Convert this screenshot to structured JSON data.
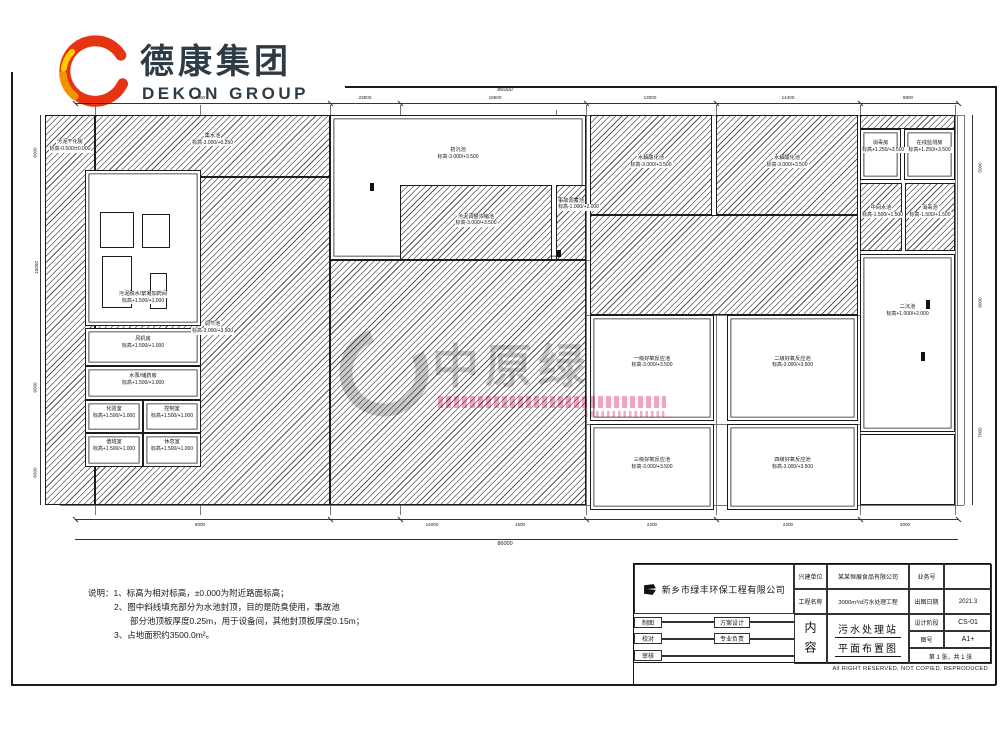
{
  "logo": {
    "title": "德康集团",
    "subtitle": "DEKON GROUP",
    "colors": {
      "red": "#e63312",
      "orange": "#f29400",
      "yellow": "#ffcf00",
      "text": "#2e3b45"
    }
  },
  "watermark": {
    "text": "中原绿",
    "accent_pink": "#ee86a6",
    "gray": "#c7c7c7"
  },
  "plan": {
    "tanks": [
      {
        "name": "污泥干化房",
        "elev": "标高-0.500/±0.000",
        "x": 45,
        "y": 115,
        "w": 50,
        "h": 390,
        "hatch": true,
        "lt": 6
      },
      {
        "name": "集水池",
        "elev": "标高-3.000/+0.250",
        "x": 95,
        "y": 115,
        "w": 235,
        "h": 62,
        "hatch": true,
        "lt": 28
      },
      {
        "name": "调节池",
        "elev": "标高-3.000/+3.500",
        "x": 95,
        "y": 177,
        "w": 235,
        "h": 328,
        "hatch": true,
        "lt": 44
      },
      {
        "name": "初沉池",
        "elev": "标高-3.000/+3.500",
        "x": 330,
        "y": 115,
        "w": 256,
        "h": 145,
        "hatch": false,
        "lt": 22
      },
      {
        "name": "",
        "elev": "",
        "x": 330,
        "y": 260,
        "w": 256,
        "h": 245,
        "hatch": true,
        "lt": 40
      },
      {
        "name": "污泥调整浓缩池",
        "elev": "标高-3.000/+3.500",
        "x": 400,
        "y": 185,
        "w": 152,
        "h": 75,
        "hatch": true,
        "lt": 38
      },
      {
        "name": "事故调蓄池",
        "elev": "标高-1.000/+2.000",
        "x": 556,
        "y": 185,
        "w": 30,
        "h": 75,
        "hatch": true,
        "lt": 16
      },
      {
        "name": "水解酸化池",
        "elev": "标高-3.000/+3.500",
        "x": 590,
        "y": 115,
        "w": 122,
        "h": 100,
        "hatch": true,
        "lt": 40
      },
      {
        "name": "水解酸化池",
        "elev": "标高-3.000/+3.500",
        "x": 716,
        "y": 115,
        "w": 142,
        "h": 100,
        "hatch": true,
        "lt": 40
      },
      {
        "name": "",
        "elev": "",
        "x": 590,
        "y": 215,
        "w": 268,
        "h": 100,
        "hatch": true,
        "lt": 40
      },
      {
        "name": "一级好氧反应池",
        "elev": "标高-3.000/+3.500",
        "x": 590,
        "y": 315,
        "w": 124,
        "h": 106,
        "hatch": false,
        "lt": 38
      },
      {
        "name": "二级好氧反应池",
        "elev": "标高-3.000/+3.500",
        "x": 727,
        "y": 315,
        "w": 131,
        "h": 106,
        "hatch": false,
        "lt": 38
      },
      {
        "name": "三级好氧反应池",
        "elev": "标高-3.000/+3.500",
        "x": 590,
        "y": 424,
        "w": 124,
        "h": 86,
        "hatch": false,
        "lt": 38
      },
      {
        "name": "四级好氧反应池",
        "elev": "标高-3.000/+3.500",
        "x": 727,
        "y": 424,
        "w": 131,
        "h": 86,
        "hatch": false,
        "lt": 38
      },
      {
        "name": "",
        "elev": "",
        "x": 860,
        "y": 115,
        "w": 95,
        "h": 14,
        "hatch": true,
        "lt": 10
      },
      {
        "name": "消毒房",
        "elev": "标高+1.250/+3.500",
        "x": 860,
        "y": 129,
        "w": 41,
        "h": 51,
        "hatch": false,
        "lt": 20
      },
      {
        "name": "在线监测房",
        "elev": "标高+1.250/+3.500",
        "x": 904,
        "y": 129,
        "w": 51,
        "h": 51,
        "hatch": false,
        "lt": 20
      },
      {
        "name": "中间水池",
        "elev": "标高-1.500/+1.500",
        "x": 860,
        "y": 183,
        "w": 42,
        "h": 68,
        "hatch": true,
        "lt": 32
      },
      {
        "name": "消毒池",
        "elev": "标高-1.500/+1.500",
        "x": 905,
        "y": 183,
        "w": 50,
        "h": 68,
        "hatch": true,
        "lt": 32
      },
      {
        "name": "二沉池",
        "elev": "标高+1.000/+2.000",
        "x": 860,
        "y": 254,
        "w": 95,
        "h": 178,
        "hatch": false,
        "lt": 28
      },
      {
        "name": "",
        "elev": "",
        "x": 860,
        "y": 434,
        "w": 95,
        "h": 71,
        "hatch": false,
        "lt": 40
      },
      {
        "name": "污泥脱水/絮凝加药间",
        "elev": "标高+1.500/+1.000",
        "x": 85,
        "y": 170,
        "w": 116,
        "h": 156,
        "hatch": false,
        "lt": 78
      },
      {
        "name": "风机房",
        "elev": "标高+1.500/+1.000",
        "x": 85,
        "y": 328,
        "w": 116,
        "h": 38,
        "hatch": false,
        "lt": 20
      },
      {
        "name": "水泵/储药房",
        "elev": "标高+1.500/+1.000",
        "x": 85,
        "y": 366,
        "w": 116,
        "h": 34,
        "hatch": false,
        "lt": 18
      },
      {
        "name": "化验室",
        "elev": "标高+1.500/+1.000",
        "x": 85,
        "y": 400,
        "w": 58,
        "h": 33,
        "hatch": false,
        "lt": 16
      },
      {
        "name": "控制室",
        "elev": "标高+1.500/+1.000",
        "x": 143,
        "y": 400,
        "w": 58,
        "h": 33,
        "hatch": false,
        "lt": 16
      },
      {
        "name": "值班室",
        "elev": "标高+1.500/+1.000",
        "x": 85,
        "y": 433,
        "w": 58,
        "h": 34,
        "hatch": false,
        "lt": 16
      },
      {
        "name": "休息室",
        "elev": "标高+1.500/+1.000",
        "x": 143,
        "y": 433,
        "w": 58,
        "h": 34,
        "hatch": false,
        "lt": 16
      }
    ],
    "equipment": [
      {
        "x": 100,
        "y": 212,
        "w": 34,
        "h": 36
      },
      {
        "x": 142,
        "y": 214,
        "w": 28,
        "h": 34
      },
      {
        "x": 102,
        "y": 256,
        "w": 30,
        "h": 52
      },
      {
        "x": 150,
        "y": 273,
        "w": 17,
        "h": 36
      }
    ],
    "marks": [
      {
        "x": 926,
        "y": 300,
        "w": 4,
        "h": 9
      },
      {
        "x": 921,
        "y": 352,
        "w": 4,
        "h": 9
      },
      {
        "x": 370,
        "y": 183,
        "w": 4,
        "h": 8
      },
      {
        "x": 556,
        "y": 250,
        "w": 5,
        "h": 7
      }
    ],
    "dims": {
      "top": [
        {
          "t": "8000",
          "x": 200
        },
        {
          "t": "23500",
          "x": 365
        },
        {
          "t": "18600",
          "x": 495
        },
        {
          "t": "13000",
          "x": 650
        },
        {
          "t": "14400",
          "x": 788
        },
        {
          "t": "9800",
          "x": 908
        }
      ],
      "top_total": "86000",
      "bottom": [
        {
          "t": "8000",
          "x": 200
        },
        {
          "t": "14000",
          "x": 432
        },
        {
          "t": "1500",
          "x": 520
        },
        {
          "t": "2200",
          "x": 652
        },
        {
          "t": "2200",
          "x": 788
        },
        {
          "t": "3000",
          "x": 905
        }
      ],
      "bottom_total": "86000",
      "left": [
        {
          "t": "6000",
          "y": 150
        },
        {
          "t": "15000",
          "y": 265
        },
        {
          "t": "9000",
          "y": 385
        },
        {
          "t": "6500",
          "y": 470
        }
      ],
      "right": [
        {
          "t": "5000",
          "y": 165
        },
        {
          "t": "8000",
          "y": 300
        },
        {
          "t": "7000",
          "y": 430
        }
      ]
    }
  },
  "notes": {
    "lines": [
      {
        "t": "说明：1、标高为相对标高，±0.000为附近路面标高；",
        "ind": 0
      },
      {
        "t": "2、图中斜线填充部分为水池封顶，目的是防臭使用，事故池",
        "ind": 26
      },
      {
        "t": "部分池顶板厚度0.25m，用于设备间，其他封顶板厚度0.15m；",
        "ind": 42
      },
      {
        "t": "3、占地面积约3500.0m²。",
        "ind": 26
      }
    ]
  },
  "titleblock": {
    "company": "新乡市绿丰环保工程有限公司",
    "owner_label": "兴建单位",
    "owner": "某某恒展食品有限公司",
    "project_label": "工程名称",
    "project": "3000m³/d污水处理工程",
    "biz_label": "业务号",
    "biz": "",
    "date_label": "出图日期",
    "date": "2021.3",
    "draft_label": "制图",
    "scheme_label": "方案设计",
    "check_label": "校对",
    "lead_label": "专业负责",
    "review_label": "审核",
    "content_label": "内容",
    "content_line1": "污水处理站",
    "content_line2": "平面布置图",
    "stage_label": "设计阶段",
    "stage": "CS-01",
    "figno_label": "图号",
    "figno": "A1+",
    "sheet": "第 1 张，共 1 张",
    "copyright": "All RIGHT RESERVED, NOT COPIED, REPRODUCED"
  }
}
